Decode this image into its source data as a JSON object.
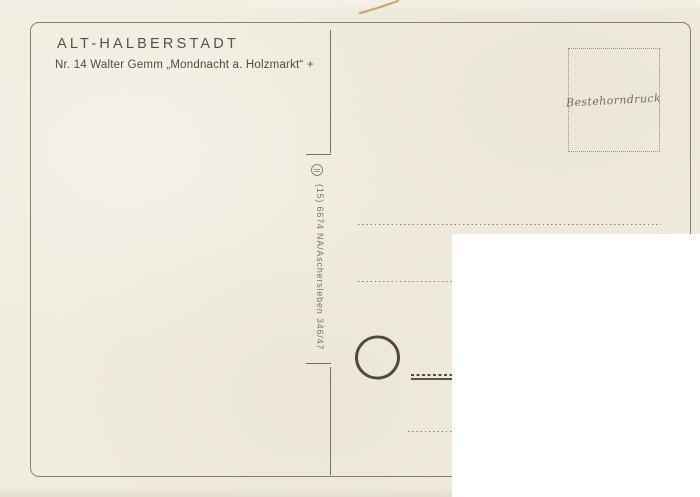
{
  "card": {
    "title": "ALT-HALBERSTADT",
    "subtitle": "Nr. 14 Walter Gemm „Mondnacht a. Holzmarkt“ +",
    "stamp_box": {
      "label": "Bestehorndruck"
    },
    "imprint": {
      "text": "(15) 6674 NA/Aschersleben 346/47"
    },
    "icons": [
      {
        "name": "publisher-logo-circle",
        "description": "small circled printer monogram"
      },
      {
        "name": "postmark-circle",
        "description": "empty round postmark outline"
      },
      {
        "name": "scratch-mark",
        "description": "thin golden scratch on scan top edge"
      }
    ],
    "colors": {
      "paper": "#f0ecdf",
      "frame_line": "#6a6658",
      "text": "#4e4c43",
      "dotted_line": "#86826f",
      "postmark": "#4d4a42",
      "overlay": "#ffffff",
      "scratch": "#c69a55"
    }
  }
}
